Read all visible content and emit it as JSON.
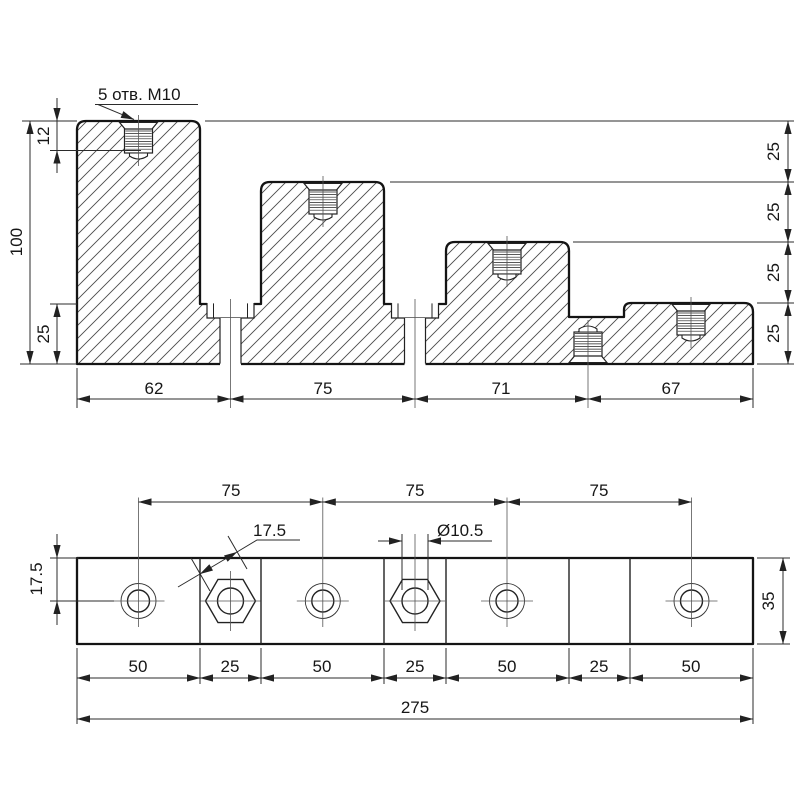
{
  "front_view": {
    "callout": "5 отв. М10",
    "thread_depth": "12",
    "height": "100",
    "base_height": "25",
    "step_widths": [
      "62",
      "75",
      "71",
      "67"
    ],
    "step_heights": [
      "25",
      "25",
      "25",
      "25"
    ]
  },
  "plan_view": {
    "hole_pitches": [
      "75",
      "75",
      "75"
    ],
    "hex_across_flats": "17.5",
    "hole_diameter": "Ø10.5",
    "edge_to_center": "17.5",
    "plate_width": "35",
    "segment_widths": [
      "50",
      "25",
      "50",
      "25",
      "50",
      "25",
      "50"
    ],
    "total_length": "275"
  }
}
